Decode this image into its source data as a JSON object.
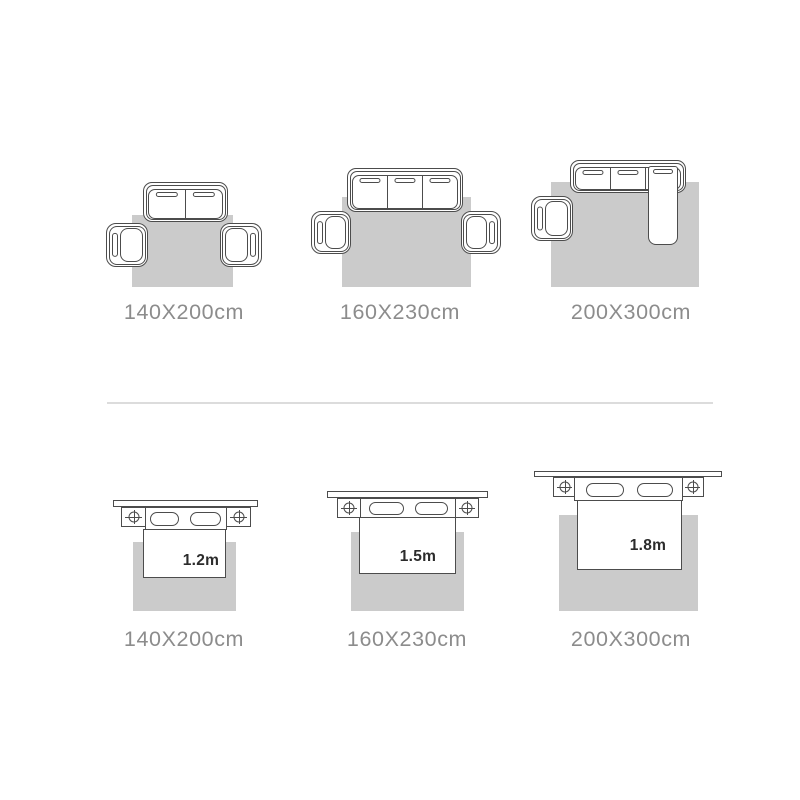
{
  "colors": {
    "background": "#ffffff",
    "rug_fill": "#cbcbcb",
    "line": "#4c4c4c",
    "label_text": "#8c8c8c",
    "size_text": "#2b2b2b",
    "divider": "#dcdcdc"
  },
  "sofa_diagrams": [
    {
      "label": "140X200cm",
      "seats": 2,
      "armchairs": 2,
      "chaise": false
    },
    {
      "label": "160X230cm",
      "seats": 3,
      "armchairs": 2,
      "chaise": false
    },
    {
      "label": "200X300cm",
      "seats": 3,
      "armchairs": 1,
      "chaise": true
    }
  ],
  "bed_diagrams": [
    {
      "bed_size": "1.2m",
      "label": "140X200cm"
    },
    {
      "bed_size": "1.5m",
      "label": "160X230cm"
    },
    {
      "bed_size": "1.8m",
      "label": "200X300cm"
    }
  ]
}
